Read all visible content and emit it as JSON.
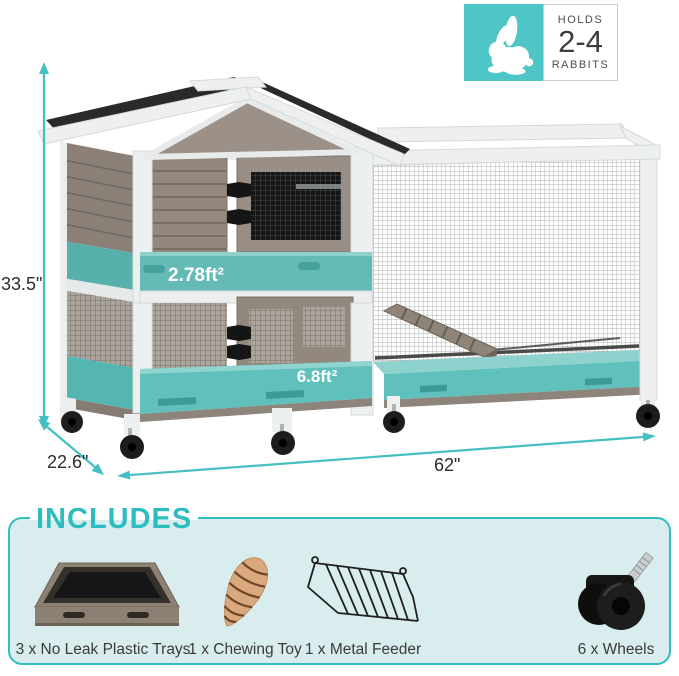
{
  "badge": {
    "icon": "rabbit-icon",
    "line1": "HOLDS",
    "line2": "2-4",
    "line3": "RABBITS"
  },
  "dimensions": {
    "height": "33.5\"",
    "depth": "22.6\"",
    "width": "62\""
  },
  "areas": {
    "upper_level": "2.78ft²",
    "lower_level": "6.8ft²"
  },
  "includes": {
    "title": "INCLUDES",
    "items": [
      {
        "icon": "plastic-tray-icon",
        "label": "3 x No Leak Plastic Trays"
      },
      {
        "icon": "chewing-toy-icon",
        "label": "1 x Chewing Toy"
      },
      {
        "icon": "metal-feeder-icon",
        "label": "1 x Metal Feeder"
      },
      {
        "icon": "caster-wheel-icon",
        "label": "6 x Wheels"
      }
    ]
  },
  "colors": {
    "accent_teal": "#45BFC1",
    "badge_teal": "#4EC5C6",
    "includes_accent": "#2DBDBF",
    "includes_bg": "#D9EDEF",
    "tray_teal": "#5FC0BC"
  }
}
